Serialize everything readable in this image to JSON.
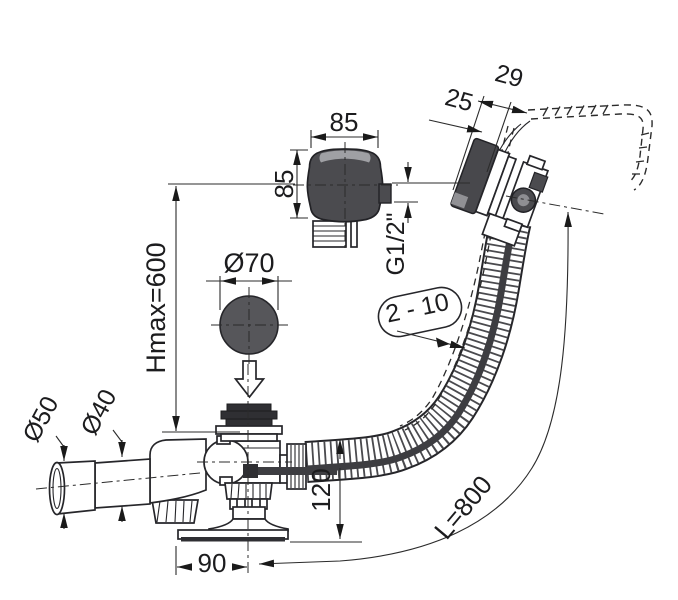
{
  "figure": {
    "type": "technical-dimension-drawing",
    "subject": "Bathtub waste and overflow set with control knob, pop-up plug, siphon and flexible corrugated hose"
  },
  "colors": {
    "line": "#2b2b2b",
    "dark_fill": "#4b4b4f",
    "plug_gray": "#56565a",
    "disc_dark": "#2f2f33",
    "cable_dark": "#3d3d41",
    "inner_gray": "#8e8e92",
    "background": "#ffffff"
  },
  "labels": {
    "knob_width": "85",
    "knob_height": "85",
    "thread_size": "G1/2\"",
    "rim_offset_outer": "29",
    "rim_offset_inner": "25",
    "height_max": "Hmax=600",
    "plug_diameter": "Ø70",
    "wall_thickness_range": "2 - 10",
    "outlet_sleeve_diameter": "Ø50",
    "outlet_pipe_diameter": "Ø40",
    "base_height": "120",
    "base_offset": "90",
    "hose_length": "L=800"
  }
}
